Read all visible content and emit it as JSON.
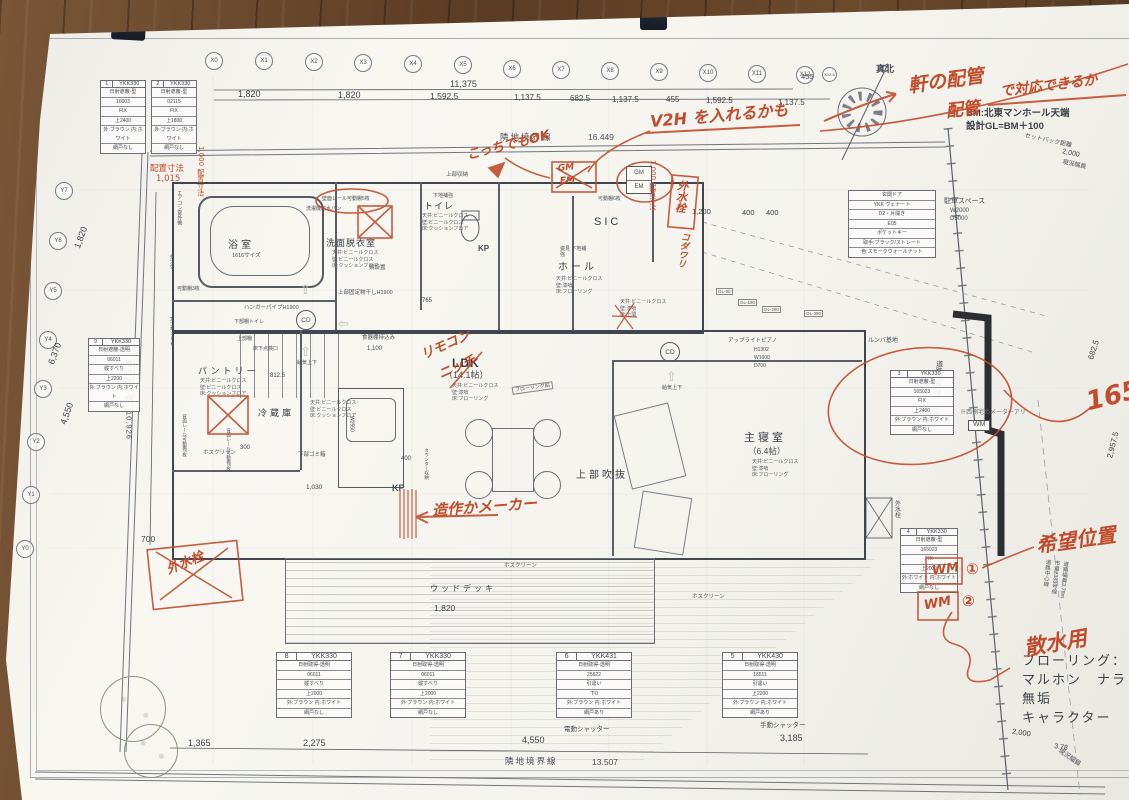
{
  "meta": {
    "north_label": "真北",
    "bm_line1": "BM:北東マンホール天端",
    "bm_line2": "設計GL=BM＋100"
  },
  "grid": {
    "x_labels": [
      "X0",
      "X1",
      "X2",
      "X3",
      "X4",
      "X5",
      "X6",
      "X7",
      "X8",
      "X9",
      "X10",
      "X11",
      "X12",
      "X12.5"
    ],
    "y_labels": [
      "Y7",
      "Y6",
      "Y5",
      "Y4",
      "Y3",
      "Y2",
      "Y1",
      "Y0"
    ]
  },
  "dims": {
    "top_total": "11,375",
    "seg": [
      "1,820",
      "1,820",
      "1,592.5",
      "1,137.5",
      "682.5",
      "1,137.5",
      "455",
      "1,592.5",
      "1,137.5"
    ],
    "x12_offset": "455",
    "left_1820": "1,820",
    "left_6370": "6,370",
    "left_4550": "4,550",
    "left_700": "700",
    "bottom_1365": "1,365",
    "bottom_2275": "2,275",
    "bottom_4550": "4,550",
    "bottom_3185": "3,185",
    "right_6825": "682.5",
    "right_29575": "2,957.5",
    "deck_1820": "1,820",
    "porch_1200": "1,200",
    "porch_400a": "400",
    "porch_400b": "400",
    "road_2000": "2,000",
    "road_378": "3.78",
    "top_2000": "2,000",
    "k_400": "400",
    "k_1030": "1,030",
    "k_1100": "1,100",
    "k_8125": "812.5",
    "k_300": "300",
    "k_765": "765",
    "k_w2550": "W2550"
  },
  "boundaries": {
    "north": "隣地境界線",
    "north_v": "16.449",
    "west": "隣地境界線　10.926",
    "south": "隣地境界線",
    "south_v": "13.507",
    "road": "道路境界線　10.848",
    "road_center": [
      "道路中心線",
      "市道2383号線",
      "道路幅員3.78m"
    ],
    "genkyo_top": "現況幅員",
    "genkyo_bottom": "現況幅員",
    "setback": "セットバック距離"
  },
  "rooms": {
    "bath": {
      "name": "浴室",
      "sub": "1616サイズ"
    },
    "wash": {
      "name": "洗面脱衣室",
      "f": [
        "天井:ビニールクロス",
        "壁:ビニールクロス",
        "床:クッションフロア"
      ]
    },
    "toilet": {
      "name": "トイレ",
      "f": [
        "天井:ビニールクロス",
        "壁:ビニールクロス",
        "床:クッションフロア"
      ]
    },
    "hall": {
      "name": "ホール",
      "f": [
        "天井:ビニールクロス",
        "壁:漆喰",
        "床:フローリング"
      ]
    },
    "sic": {
      "name": "SIC"
    },
    "pantry": {
      "name": "パントリー",
      "f": [
        "天井:ビニールクロス",
        "壁:ビニールクロス",
        "床:クッションフロア"
      ]
    },
    "fridge": {
      "name": "冷蔵庫",
      "f": [
        "天井:ビニールクロス",
        "壁:ビニールクロス",
        "床:クッションフロア"
      ]
    },
    "ldk": {
      "name": "LDK",
      "size": "（14.1帖）",
      "f": [
        "天井:ビニールクロス",
        "壁:漆喰",
        "床:フローリング"
      ]
    },
    "bed": {
      "name": "主寝室",
      "size": "（6.4帖）",
      "f": [
        "天井:ビニールクロス",
        "壁:漆喰",
        "床:フローリング"
      ]
    },
    "genkan_f": [
      "天井:ビニールクロス",
      "壁:漆喰",
      "床:土間"
    ],
    "void": {
      "name": "上部吹抜"
    },
    "deck": {
      "name": "ウッドデッキ"
    }
  },
  "labels": {
    "jobu_shuno": "上部収納",
    "shitaji": "下地補強",
    "sentakuki": "洗濯機防水パン",
    "kabe_rail": "壁面レール可動棚5枚",
    "kagami": "鏡設置",
    "monohoshi": "上部固定物干しH1900",
    "hanger": "ハンガーパイプH1900",
    "kadou3": "可動棚3枚",
    "kabu_tana": "下部棚トイレ",
    "jobu_tana": "上部棚",
    "shokkidana": "食器棚持込み",
    "ecocute": "エコキュート",
    "tank": "タンク",
    "aircon": "エアコン室外機",
    "kadou6": "可動棚6枚",
    "sugata": "姿見 下地補強",
    "hosuku": "ホスクリーン",
    "gomibako": "下部ゴミ箱",
    "haimen_rail": "背面レール可動棚5枚",
    "counter": "カウンター収納",
    "kp": "KP",
    "cd": "CD",
    "piano": "アップライトピアノ",
    "piano_h": "H1302",
    "piano_w": "W1600",
    "piano_d": "D700",
    "rumba": "ルンバ基地",
    "meter_note": "※西側宅のメーターアリ",
    "wm": "WM",
    "gm": "GM",
    "em": "EM",
    "flooring_tag": "フローリング貼",
    "yukashita": "床下点検口",
    "kyuki": "給気上下",
    "e_shutter": "電動シャッター",
    "m_shutter": "手動シャッター",
    "gl_tags": [
      "GL-90",
      "GL-190",
      "GL-290",
      "GL-390"
    ],
    "sotosui": "外水栓"
  },
  "entrance_door": {
    "rows": [
      "玄関ドア",
      "YKK ヴェナート",
      "D2・片開き",
      "E05",
      "ポケットキー",
      "取手:ブラック/ストレート",
      "色:スモークウォールナット"
    ]
  },
  "parking": {
    "name": "駐車スペース",
    "w": "W2000",
    "d": "D5000"
  },
  "window_schedules": [
    {
      "num": "1",
      "code": "YKK330",
      "rows": [
        "日射遮蔽-型",
        "16003",
        "FIX",
        "上2400",
        "外:ブラウン 内:ホワイト",
        "網戸なし"
      ]
    },
    {
      "num": "2",
      "code": "YKK330",
      "rows": [
        "日射遮蔽-型",
        "02115",
        "FIX",
        "上1800",
        "外:ブラウン 内:ホワイト",
        "網戸なし"
      ]
    },
    {
      "num": "3",
      "code": "YKK330",
      "rows": [
        "日射遮蔽-型",
        "165023",
        "FIX",
        "上2400",
        "外:ブラウン 内:ホワイト",
        "網戸なし"
      ]
    },
    {
      "num": "4",
      "code": "YKK330",
      "rows": [
        "日射遮蔽-型",
        "165023",
        "FIX",
        "上2000",
        "外:ホワイト 内:ホワイト",
        "網戸なし"
      ]
    },
    {
      "num": "5",
      "code": "YKK430",
      "rows": [
        "日射取得-透明",
        "16511",
        "引違い",
        "上2200",
        "外:ブラウン 内:ホワイト",
        "網戸あり"
      ]
    },
    {
      "num": "6",
      "code": "YKK431",
      "rows": [
        "日射取得-透明",
        "25622",
        "引違い",
        "下0",
        "外:ブラウン 内:ホワイト",
        "網戸あり"
      ]
    },
    {
      "num": "7",
      "code": "YKK330",
      "rows": [
        "日射取得-透明",
        "06011",
        "縦すべり",
        "上2000",
        "外:ブラウン 内:ホワイト",
        "網戸なし"
      ]
    },
    {
      "num": "8",
      "code": "YKK330",
      "rows": [
        "日射取得-透明",
        "06011",
        "縦すべり",
        "上2000",
        "外:ブラウン 内:ホワイト",
        "網戸なし"
      ]
    },
    {
      "num": "9",
      "code": "YKK330",
      "rows": [
        "日射遮蔽-透明",
        "06011",
        "縦すべり",
        "上2200",
        "外:ブラウン 内:ホワイト",
        "網戸なし"
      ]
    }
  ],
  "flooring_note": [
    "フローリング：",
    "マルホン　ナラ無垢",
    "キャラクター"
  ],
  "red_notes": {
    "kocchi": "こっちでもOK",
    "v2h": "V2H を入れるかも",
    "haikan1": "軒の配管",
    "haikan2": "配管",
    "haikan3": "で対応できるか",
    "haichi1": "配置寸法",
    "haichi1v": "1,015",
    "haichi2": "1,000 配置寸法",
    "haichi3": "1,000 配置寸法",
    "remocon1": "リモコン",
    "remocon2": "ニッチ",
    "zousaku": "造作かメーカー",
    "sotosuisen": "外水栓",
    "kodawari": "コダワリ",
    "num165": "165",
    "kibou": "希望位置",
    "sansui": "散水用",
    "wm1": "WM",
    "wm1n": "①",
    "wm2": "WM",
    "wm2n": "②",
    "gm": "GM",
    "em": "EM"
  },
  "colors": {
    "red": "#c24b2b",
    "paper": "#f6f5f0",
    "wood": "#6b4a2f",
    "line": "#4a4f57"
  }
}
